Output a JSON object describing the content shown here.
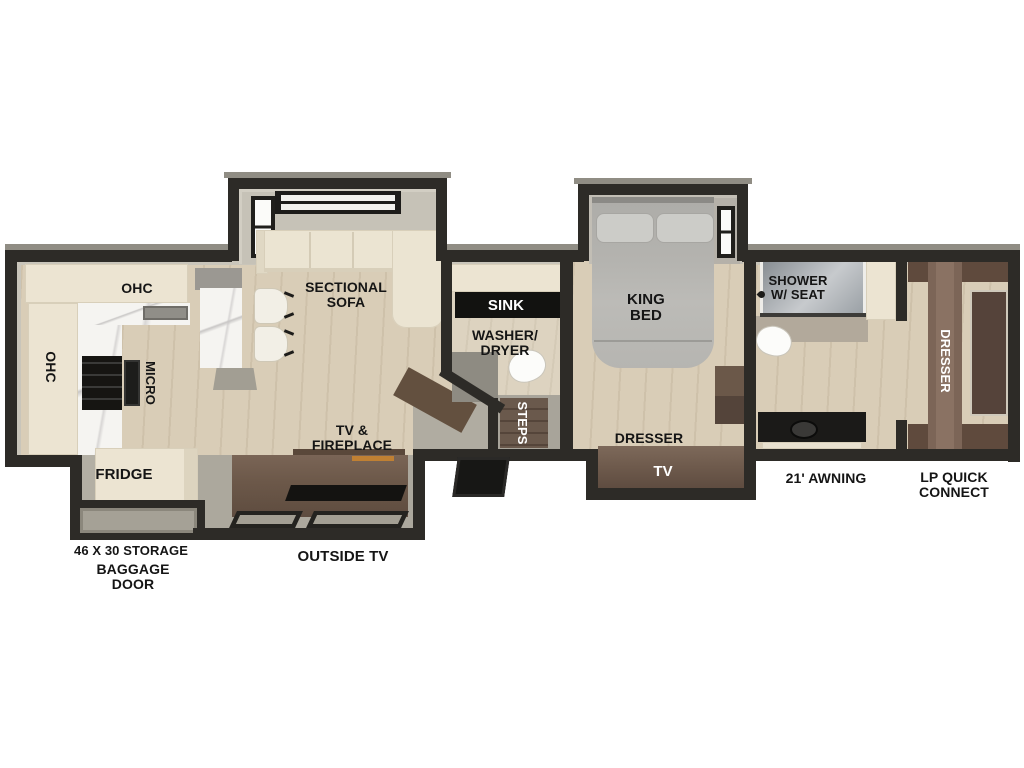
{
  "plan": {
    "kitchen": {
      "ohc_top": "OHC",
      "ohc_left": "OHC",
      "micro": "MICRO",
      "fridge": "FRIDGE"
    },
    "living_room": {
      "sofa_line1": "SECTIONAL",
      "sofa_line2": "SOFA",
      "tv_line1": "TV &",
      "tv_line2": "FIREPLACE"
    },
    "mid_bath": {
      "sink": "SINK",
      "washer_line1": "WASHER/",
      "washer_line2": "DRYER",
      "steps": "STEPS"
    },
    "bedroom": {
      "bed_line1": "KING",
      "bed_line2": "BED",
      "dresser": "DRESSER",
      "tv": "TV"
    },
    "front_bath": {
      "shower_line1": "SHOWER",
      "shower_line2": "W/ SEAT",
      "dresser": "DRESSER"
    },
    "exterior": {
      "storage": "46 X 30 STORAGE",
      "baggage_line1": "BAGGAGE",
      "baggage_line2": "DOOR",
      "outside_tv": "OUTSIDE TV",
      "awning": "21' AWNING",
      "lp_line1": "LP QUICK",
      "lp_line2": "CONNECT"
    }
  },
  "colors": {
    "wall": "#2d2b27",
    "floor_wood": "#d9cdb7",
    "floor_gray": "#aca89d",
    "cabinet_cream": "#ece4d2",
    "furniture_brown": "#6d594a",
    "bed_gray": "#b4b3af",
    "marble": "#f5f4f1",
    "appliance_black": "#161512",
    "label_text": "#151515",
    "label_text_inverse": "#ffffff",
    "fireplace_accent": "#c08033"
  }
}
